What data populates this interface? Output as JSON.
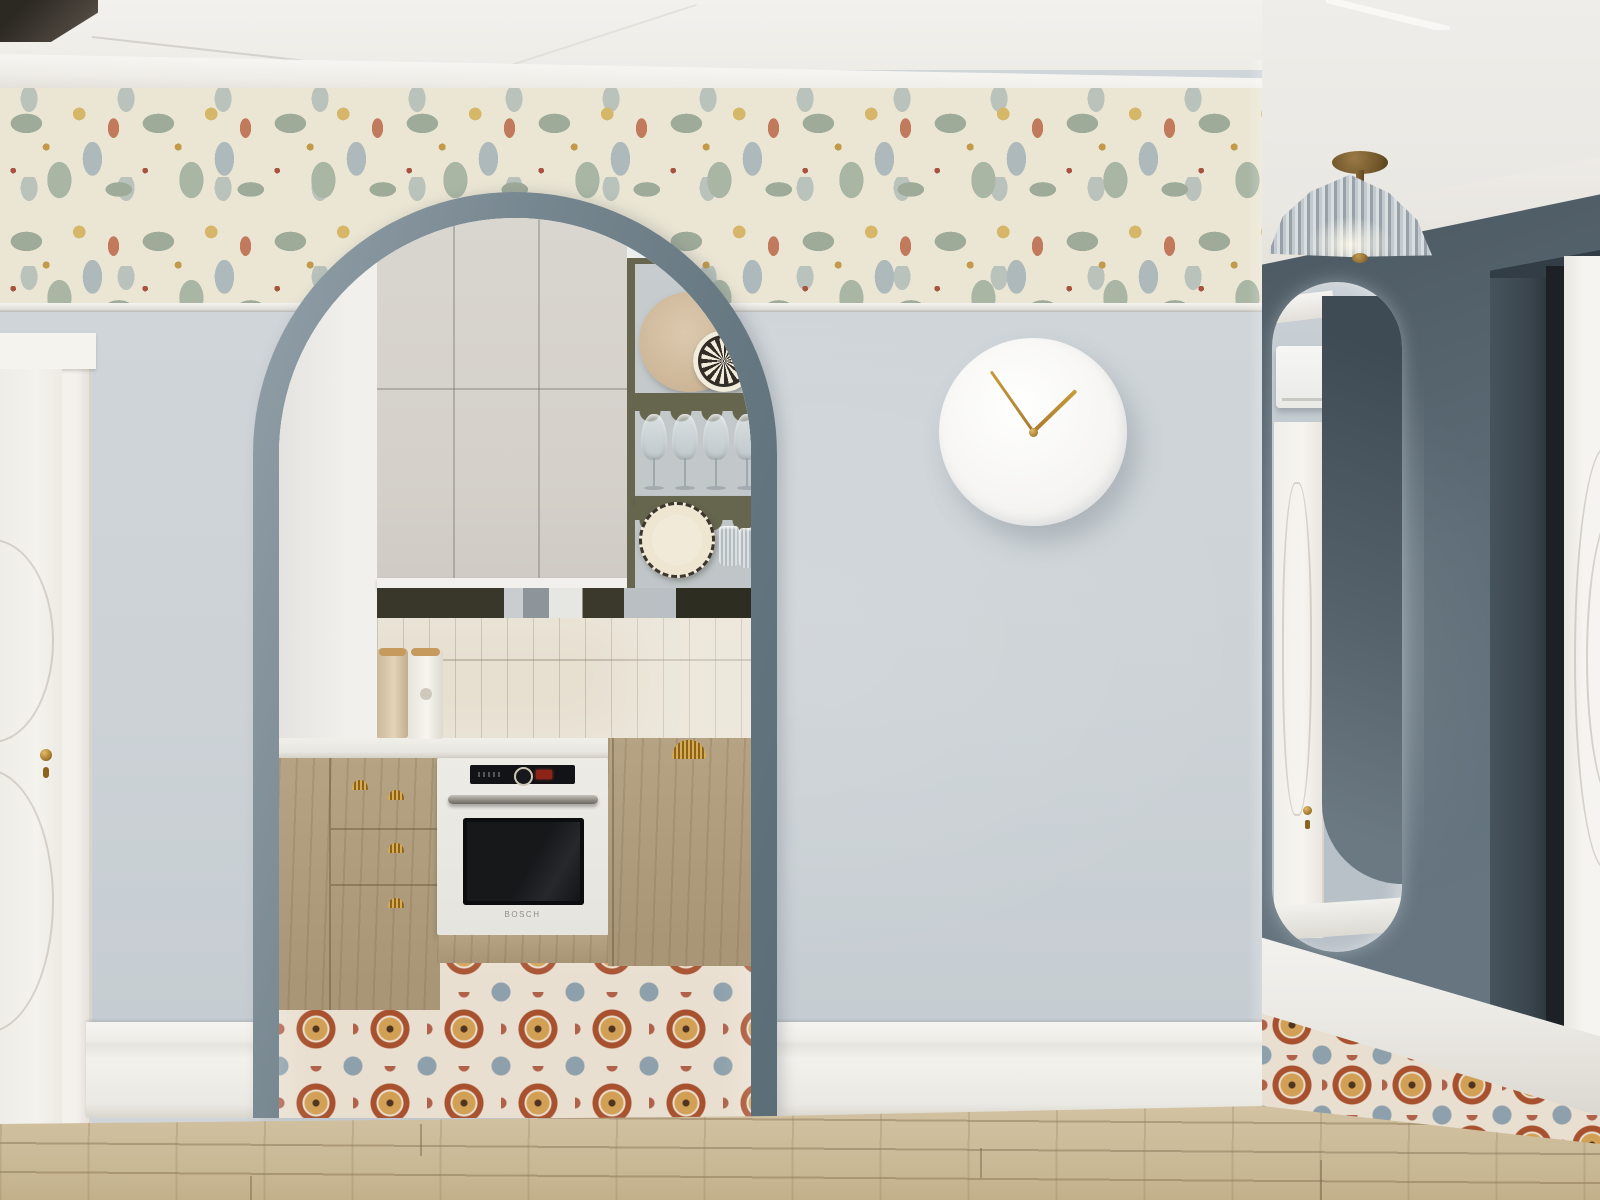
{
  "meta": {
    "description": "3D interior render: light-gray hallway wall with arched opening to a small kitchen, floral wallpaper frieze under white crown molding, white wall clock with brass hands, dark slate corridor with capsule mirror and fluted glass ceiling lamp, patterned encaustic tile floors meeting oak plank flooring"
  },
  "colors": {
    "ceiling": "#f3f1ed",
    "wall_light": "#cfd5d9",
    "wallpaper_base": "#ebe6d4",
    "sage": "#9fab99",
    "gray_blue_leaf": "#aeb9bb",
    "gold": "#d6b76a",
    "coral": "#c27a5c",
    "berry": "#a85340",
    "slate_wall": "#5d6c76",
    "slate_wall_dark": "#49565f",
    "arch_trim": "#76868f",
    "cabinet": "#d8d4cd",
    "olive": "#66654d",
    "backsplash": "#e7e0d1",
    "wood_cab": "#b5a383",
    "brass": "#a87c2e",
    "floor_tile_base": "#e9dfd0",
    "tile_rust": "#a8512f",
    "tile_gold": "#d2a055",
    "tile_slate": "#8da0ab",
    "tile_dot": "#4e3423",
    "wood_floor": "#d3c3a3",
    "white_door": "#f3f1ec",
    "black_frame": "#1d2126",
    "mirror_wall": "#b9c1c8",
    "oven_black": "#141518"
  },
  "objects": {
    "oven": {
      "brand": "BOSCH"
    },
    "clock": {
      "minute_angle_deg": -35,
      "hour_angle_deg": 46
    },
    "shelf_unit": {
      "wine_glasses": 4,
      "tumblers": 2,
      "plates": 3
    },
    "labels": {
      "left_door": "white paneled interior door",
      "arch": "arched kitchen opening with slate trim",
      "clock": "round white wall clock, brass hands",
      "lamp": "fluted glass semi-flush ceiling light",
      "mirror": "capsule wall mirror reflecting white door and AC unit",
      "right_door": "white door in black-framed recess",
      "floor": "patterned encaustic tile and oak planks"
    }
  }
}
